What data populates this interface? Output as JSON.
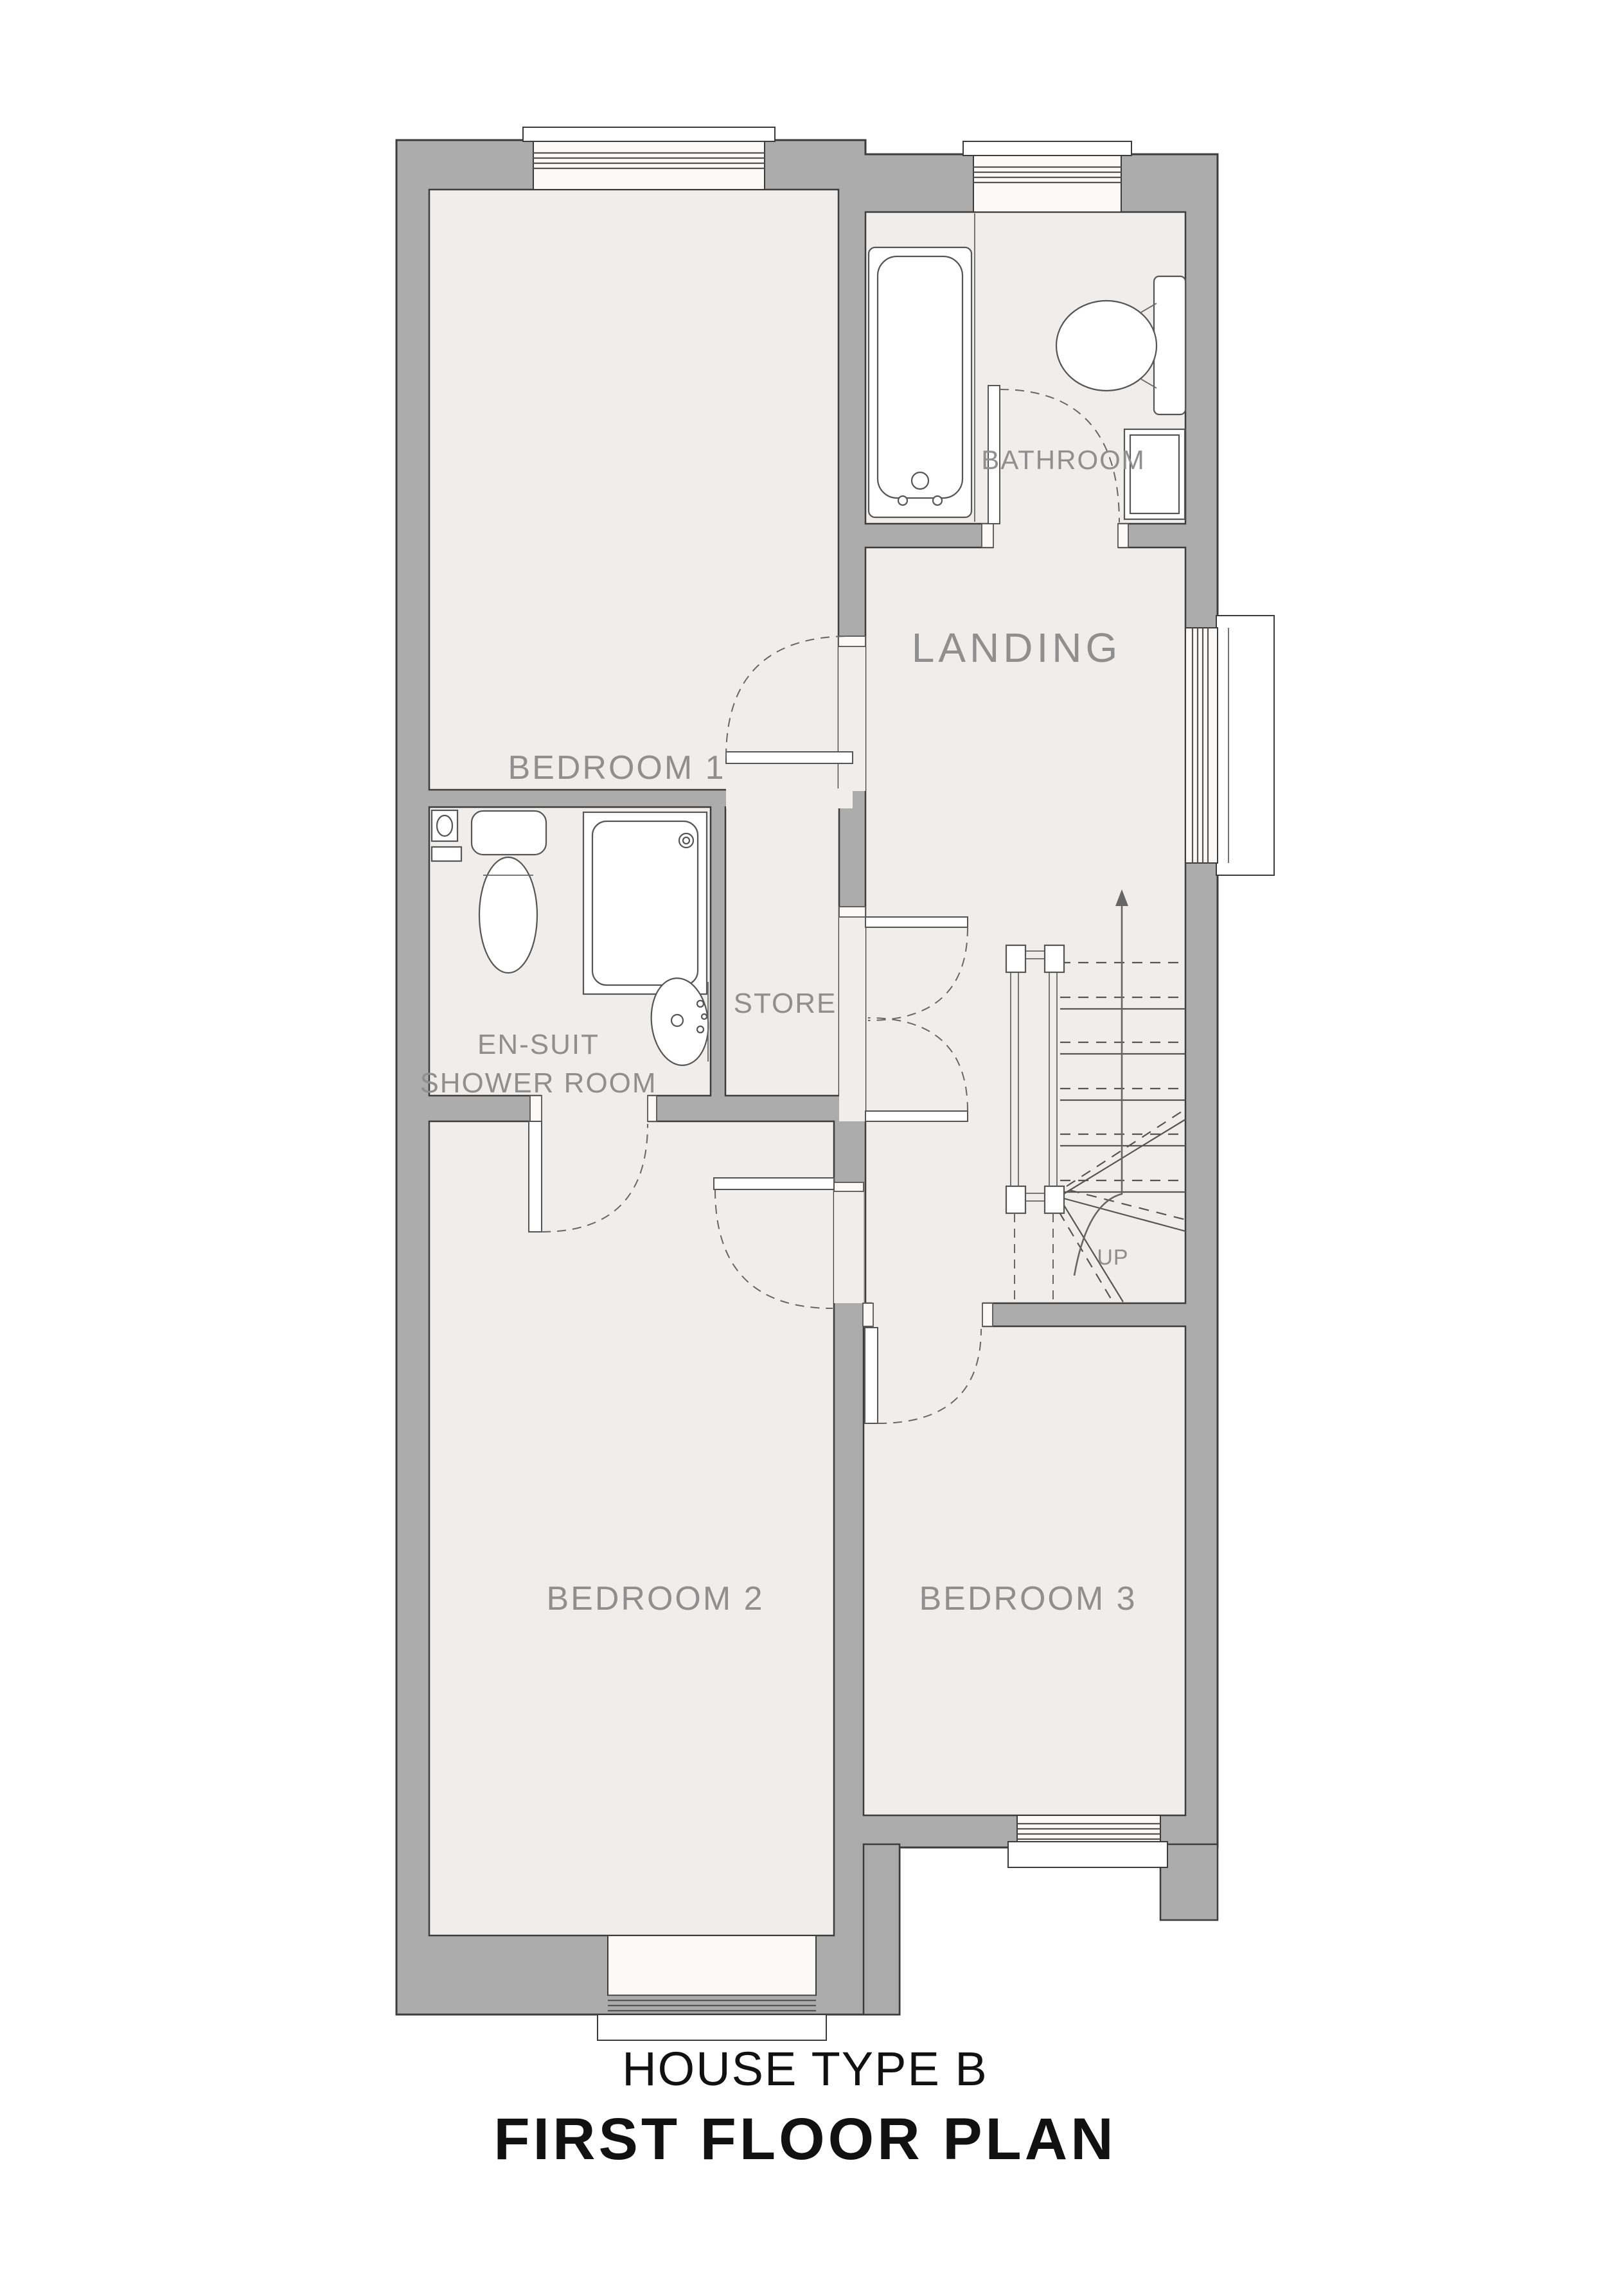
{
  "plan": {
    "titles": {
      "house_type": "HOUSE TYPE B",
      "floor_plan": "FIRST FLOOR PLAN"
    },
    "rooms": [
      {
        "id": "bedroom1",
        "label": "BEDROOM 1"
      },
      {
        "id": "bathroom",
        "label": "BATHROOM"
      },
      {
        "id": "landing",
        "label": "LANDING"
      },
      {
        "id": "ensuite",
        "label_line1": "EN-SUIT",
        "label_line2": "SHOWER ROOM"
      },
      {
        "id": "store",
        "label": "STORE"
      },
      {
        "id": "bedroom2",
        "label": "BEDROOM 2"
      },
      {
        "id": "bedroom3",
        "label": "BEDROOM 3"
      }
    ],
    "stairs": {
      "direction_label": "UP"
    },
    "fixtures": [
      "bath-icon",
      "toilet-icon",
      "radiator-icon",
      "shower-tray-icon",
      "wash-basin-icon",
      "soil-pipe-icon"
    ],
    "colors": {
      "wall": "#acacac",
      "floor": "#f0eeec",
      "outline": "#3c3c3c",
      "room_label": "#8f8f8f",
      "title": "#111111"
    }
  }
}
